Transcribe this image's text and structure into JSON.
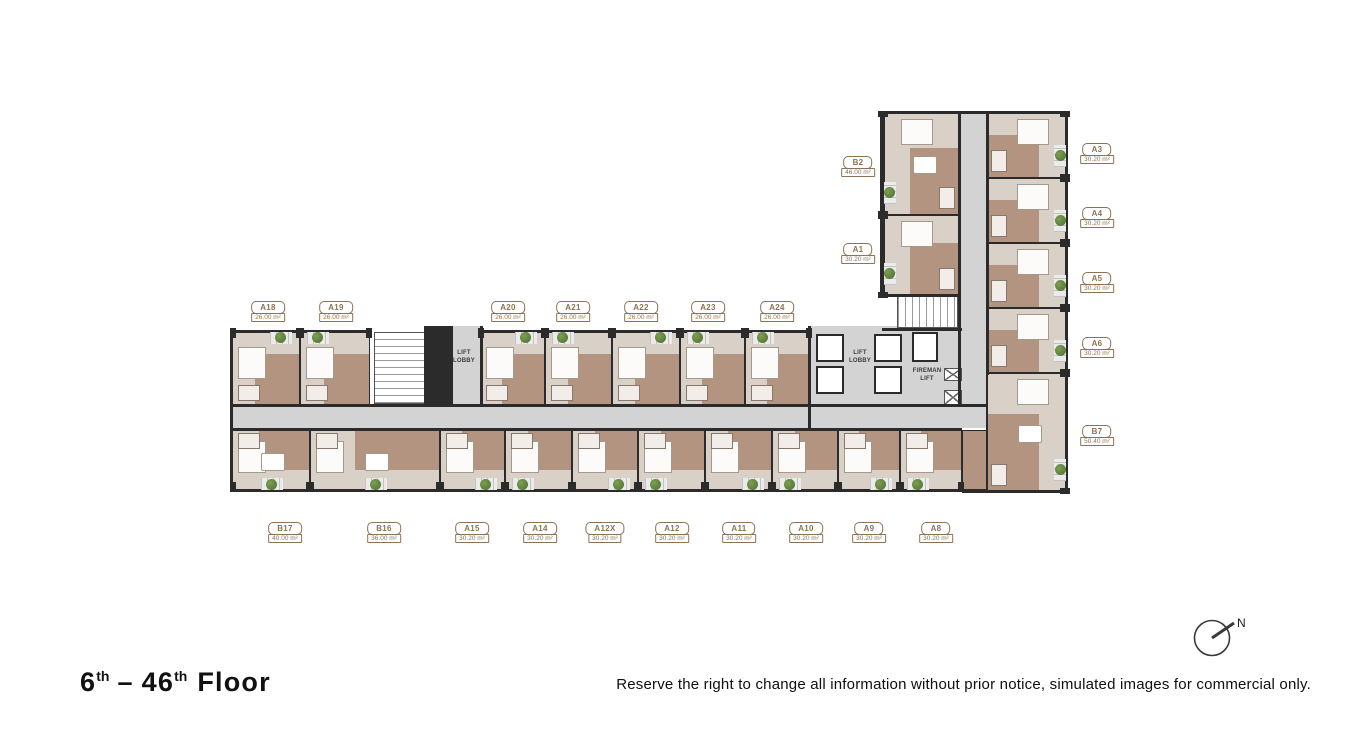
{
  "page": {
    "title": {
      "start_num": "6",
      "start_sup": "th",
      "separator": "–",
      "end_num": "46",
      "end_sup": "th",
      "suffix": "Floor"
    },
    "disclaimer": "Reserve the right to change all information without prior notice, simulated images for commercial only.",
    "compass_label": "N"
  },
  "plan": {
    "lift_lobby_west": "LIFT LOBBY",
    "lift_lobby_east": "LIFT LOBBY",
    "fireman_lift": "FIREMAN LIFT"
  },
  "colors": {
    "wall": "#2b2b2b",
    "corridor": "#d3d3d3",
    "floor_light": "#d9d0c7",
    "floor_dark": "#b29480",
    "label_brown": "#8d7253",
    "plant_green": "#4c6c2e"
  },
  "units": {
    "top_row": [
      {
        "name": "A18",
        "area": "26.00 m²"
      },
      {
        "name": "A19",
        "area": "26.00 m²"
      },
      {
        "name": "A20",
        "area": "26.00 m²"
      },
      {
        "name": "A21",
        "area": "26.00 m²"
      },
      {
        "name": "A22",
        "area": "26.00 m²"
      },
      {
        "name": "A23",
        "area": "26.00 m²"
      },
      {
        "name": "A24",
        "area": "26.00 m²"
      }
    ],
    "bottom_row": [
      {
        "name": "B17",
        "area": "40.00 m²"
      },
      {
        "name": "B16",
        "area": "36.00 m²"
      },
      {
        "name": "A15",
        "area": "30.20 m²"
      },
      {
        "name": "A14",
        "area": "30.20 m²"
      },
      {
        "name": "A12X",
        "area": "30.20 m²"
      },
      {
        "name": "A12",
        "area": "30.20 m²"
      },
      {
        "name": "A11",
        "area": "30.20 m²"
      },
      {
        "name": "A10",
        "area": "30.20 m²"
      },
      {
        "name": "A9",
        "area": "30.20 m²"
      },
      {
        "name": "A8",
        "area": "30.20 m²"
      }
    ],
    "west_wing": [
      {
        "name": "B2",
        "area": "46.00 m²"
      },
      {
        "name": "A1",
        "area": "30.20 m²"
      }
    ],
    "east_column": [
      {
        "name": "A3",
        "area": "30.20 m²"
      },
      {
        "name": "A4",
        "area": "30.20 m²"
      },
      {
        "name": "A5",
        "area": "30.20 m²"
      },
      {
        "name": "A6",
        "area": "30.20 m²"
      },
      {
        "name": "B7",
        "area": "50.40 m²"
      }
    ]
  }
}
